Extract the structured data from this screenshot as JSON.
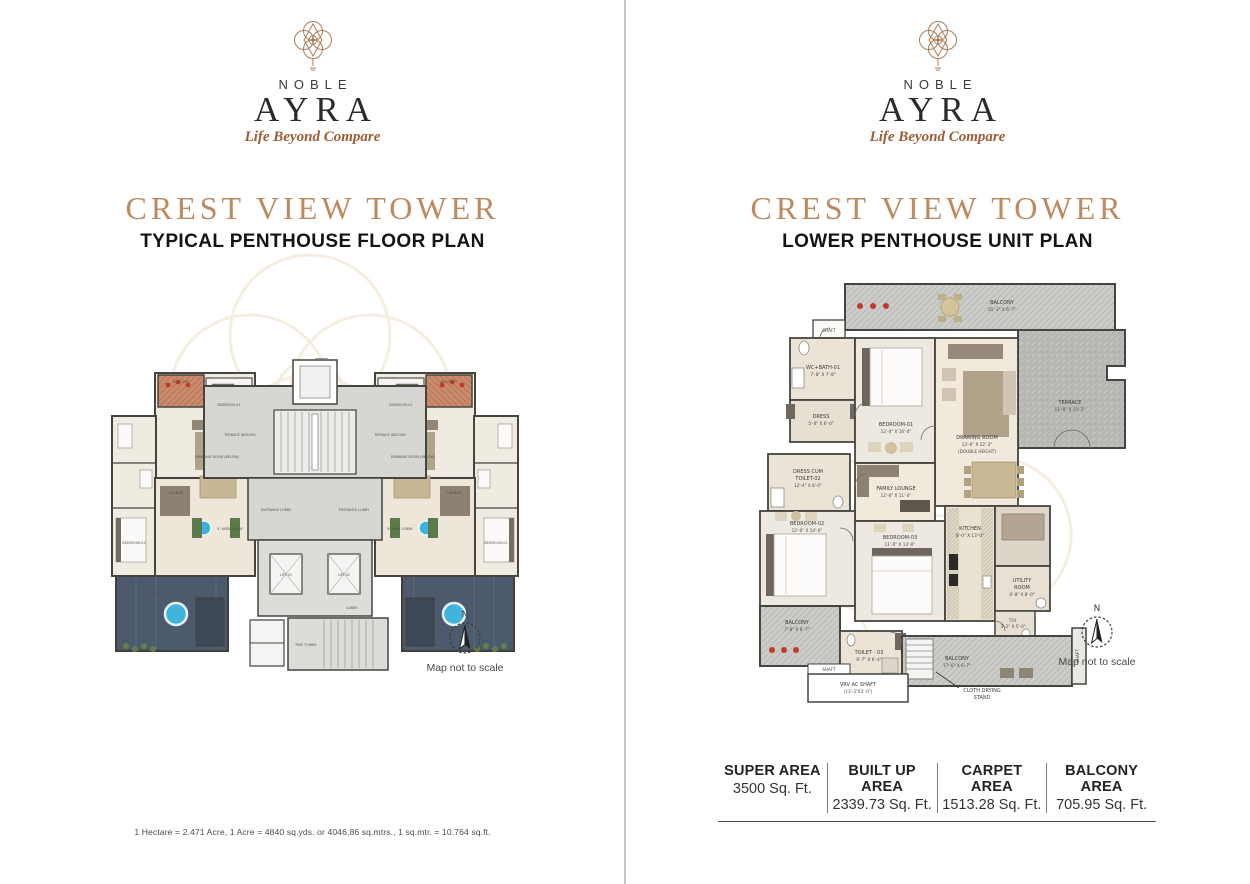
{
  "brand": {
    "name_top": "NOBLE",
    "name_main": "AYRA",
    "tagline": "Life Beyond Compare"
  },
  "compass": {
    "north": "N"
  },
  "pages": {
    "left": {
      "title": "CREST VIEW TOWER",
      "subtitle": "TYPICAL PENTHOUSE FLOOR PLAN",
      "map_note": "Map not to scale",
      "footnote": "1 Hectare = 2.471 Acre, 1 Acre = 4840 sq.yds. or 4046.86 sq.mtrs., 1 sq.mtr. = 10.764 sq.ft."
    },
    "right": {
      "title": "CREST VIEW TOWER",
      "subtitle": "LOWER PENTHOUSE UNIT PLAN",
      "map_note": "Map not to scale",
      "areas": [
        {
          "label": "SUPER AREA",
          "value": "3500 Sq. Ft."
        },
        {
          "label": "BUILT UP AREA",
          "value": "2339.73 Sq. Ft."
        },
        {
          "label": "CARPET AREA",
          "value": "1513.28 Sq. Ft."
        },
        {
          "label": "BALCONY AREA",
          "value": "705.95 Sq. Ft."
        }
      ]
    }
  },
  "left_plan": {
    "labels": [
      "BALCONY",
      "BALCONY",
      "TERRACE (BELOW)",
      "TERRACE (BELOW)",
      "DRAWING ROOM (BELOW)",
      "DRAWING ROOM (BELOW)",
      "LOUNGE",
      "LOUNGE",
      "ENTRANCE LOBBY",
      "ENTRANCE LOBBY",
      "BEDROOM-01",
      "BEDROOM-01",
      "BEDROOM-02",
      "BEDROOM-02",
      "TERRACE",
      "TERRACE",
      "LIFT-01",
      "LIFT-02",
      "FIRE TOWER",
      "LOBBY",
      "4' WIDE LOBBY",
      "4' WIDE LOBBY"
    ]
  },
  "right_plan": {
    "rooms": [
      {
        "name": "BALCONY",
        "dims": "31'-3\" X 6'-7\""
      },
      {
        "name": "TERRACE",
        "dims": "11'-0\" X 15'-2\""
      },
      {
        "name": "SHAFT"
      },
      {
        "name": "WC+BATH-01",
        "dims": "7'-8\" X 7'-8\""
      },
      {
        "name": "DRESS",
        "dims": "5'-0\" X 6'-0\""
      },
      {
        "name": "BEDROOM-01",
        "dims": "12'-0\" X 16'-0\""
      },
      {
        "name": "DRAWING ROOM",
        "dims": "13'-0\" X 22'-2\"",
        "note": "(DOUBLE HEIGHT)"
      },
      {
        "name": "DRESS CUM",
        "name2": "TOILET-02",
        "dims": "12'-4\" X 8'-0\""
      },
      {
        "name": "FAMILY LOUNGE",
        "dims": "12'-6\" X 11'-0\""
      },
      {
        "name": "BEDROOM-02",
        "dims": "12'-0\" X 14'-0\""
      },
      {
        "name": "BEDROOM-03",
        "dims": "11'-0\" X 13'-0\""
      },
      {
        "name": "KITCHEN",
        "dims": "8'-0\" X 13'-0\""
      },
      {
        "name": "UTILITY",
        "name2": "ROOM",
        "dims": "6'-8\" X 8'-0\""
      },
      {
        "name": "TOI.",
        "dims": "3'-2\" X 5'-0\""
      },
      {
        "name": "BALCONY",
        "dims": "7'-8\" X 6'-7\""
      },
      {
        "name": "TOILET - 03",
        "dims": "6'-7\" X 6'-4\""
      },
      {
        "name": "BALCONY",
        "dims": "17'-6\" X 6'-7\""
      },
      {
        "name": "SHAFT"
      },
      {
        "name": "VRV AC SHAFT",
        "dims": "(13'-3\"X3'-0\")"
      },
      {
        "name": "CLOTH DRYING",
        "name2": "STAND"
      },
      {
        "name": "SHAFT"
      }
    ]
  },
  "colors": {
    "accent": "#bd8a5f",
    "tagline": "#9e5c35",
    "wall": "#46443f",
    "pool": "#41b4dc",
    "flower": "#bf3a2b"
  }
}
